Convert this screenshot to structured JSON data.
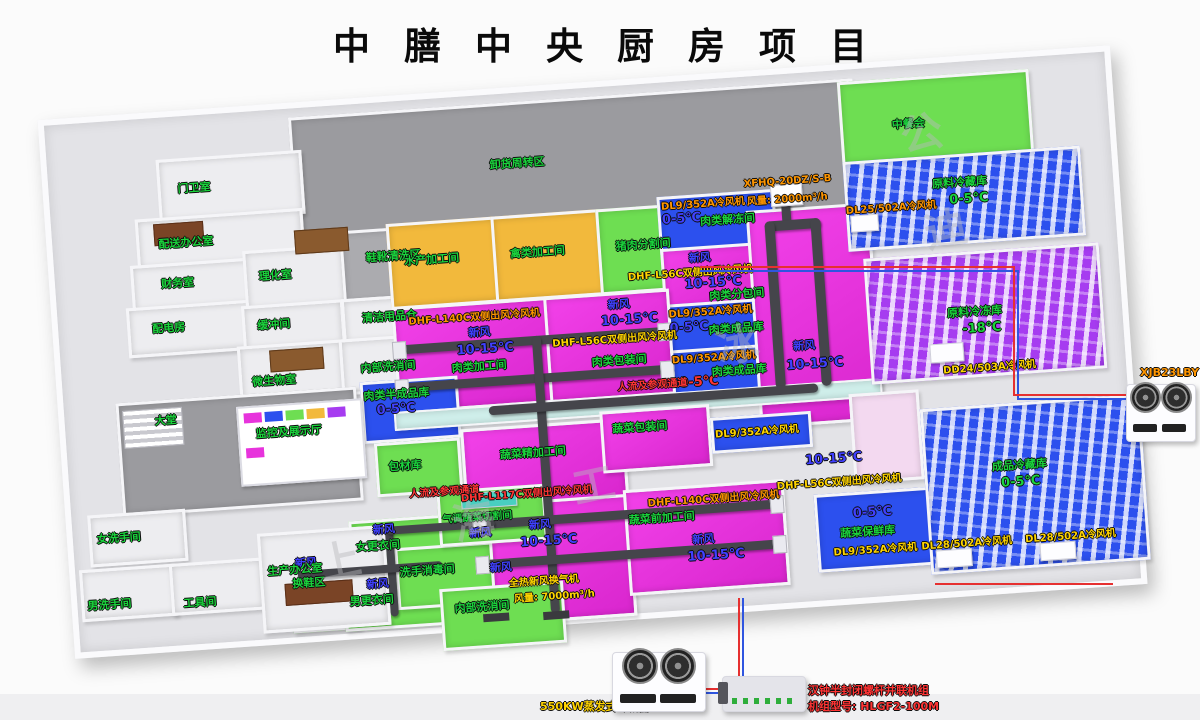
{
  "title": "中膳中央厨房项目",
  "watermark_chars": [
    "上",
    "海",
    "迪",
    "冰",
    "工",
    "公"
  ],
  "colors": {
    "magenta": "#e733dc",
    "yellow": "#f2b93c",
    "green": "#6ede52",
    "blue": "#2c50ee",
    "purple": "#a63cf0",
    "gray_zone": "#9b9b9f",
    "duct": "#45454b",
    "label_green": "#1ad43c",
    "label_blue": "#4040ff",
    "label_yellow": "#ffd400",
    "label_orange": "#ff9600",
    "label_red": "#ff3434",
    "pipe_red": "#e63030",
    "pipe_blue": "#2f55e0"
  },
  "rooms": {
    "guard": "门卫室",
    "dispatch_office": "配送办公室",
    "finance": "财务室",
    "power": "配电房",
    "lab": "理化室",
    "buffer": "缓冲间",
    "micro": "微生物室",
    "shoe_wash": "鞋靴清洗区",
    "cleaning_store": "清洁用品仓",
    "internal_wash": "内部洗消间",
    "unload": "卸货周转区",
    "aquatic": "水产加工间",
    "poultry": "禽类加工间",
    "pork_cut": "猪肉分割间",
    "meat_thaw": "肉类解冻间",
    "meat_subpack": "肉类分包间",
    "meat_process": "肉类加工间",
    "meat_pack": "肉类包装间",
    "meat_finished": "肉类成品库",
    "meat_semi": "肉类半成品库",
    "pack_material": "包材库",
    "veg_fine": "蔬菜精加工间",
    "veg_pack": "蔬菜包装间",
    "veg_pre": "蔬菜前加工间",
    "veg_fresh_store": "蔬菜保鲜库",
    "atm_veg_cut": "气调蔬菜切割间",
    "shoe_change": "换鞋区",
    "women_change": "女更衣间",
    "men_change": "男更衣间",
    "hand_wash": "洗手消毒间",
    "lobby": "大堂",
    "monitor_hall": "监控及展示厅",
    "women_wc": "女洗手间",
    "men_wc": "男洗手间",
    "tool": "工具间",
    "prod_office": "生产办公室",
    "canteen": "中餐会",
    "raw_cold": "原料冷藏库",
    "raw_freeze": "原料冷冻库",
    "finished_cold": "成品冷藏库",
    "corridor": "人流及参观通道"
  },
  "equipment": {
    "dl9": "DL9/352A冷风机",
    "dl25": "DL25/502A冷风机",
    "dl28": "DL28/502A冷风机",
    "dd24": "DD24/503A冷风机",
    "dhf56": "DHF-L56C双侧出风冷风机",
    "dhf117": "DHF-L117C双侧出风冷风机",
    "dhf140": "DHF-L140C双侧出风冷风机",
    "xfhq": "XFHQ-20DZ/S-B",
    "xfhq_flow": "风量: 2000m³/h",
    "heat_ex": "全热新风换气机",
    "heat_ex_flow": "风量: 7000m³/h",
    "condenser": "550KW蒸发式冷凝器",
    "screw_unit": "汉钟半封闭螺杆并联机组",
    "screw_model": "机组型号: HLGF2-100M",
    "xjb": "XJB23LBY"
  },
  "temps": {
    "t1015": "10-15℃",
    "t05": "0-5℃",
    "t18": "-18℃"
  },
  "fresh_air": "新风"
}
